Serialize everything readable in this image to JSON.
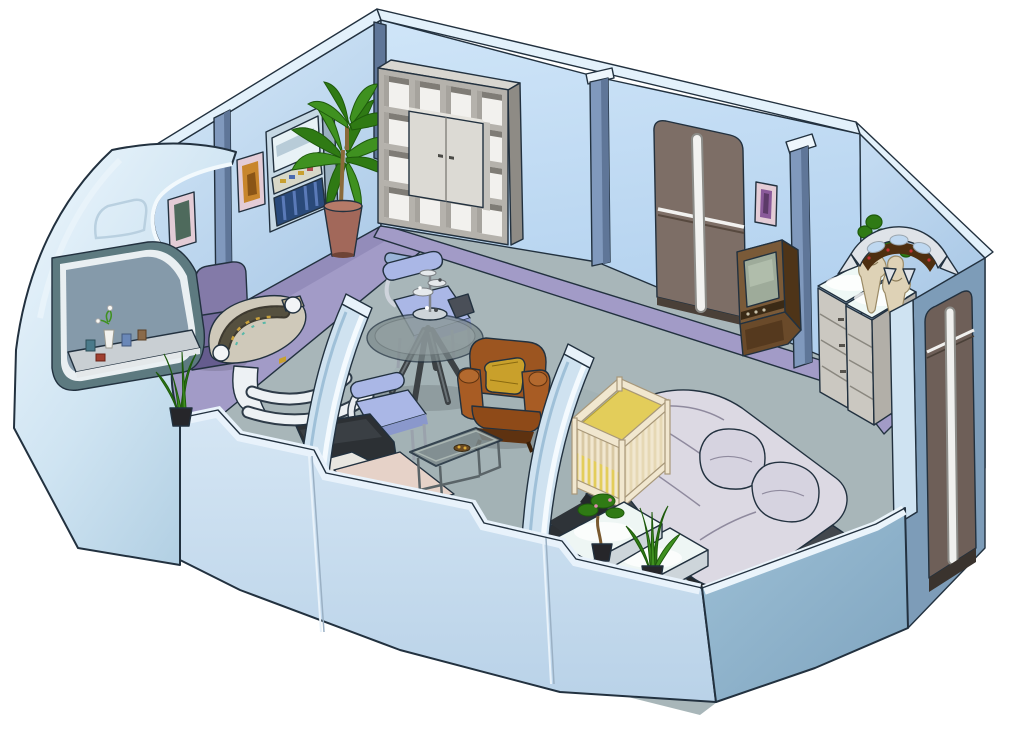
{
  "scene": {
    "type": "isometric-room-cutaway",
    "label": "isometric cutaway illustration of starship living quarters"
  },
  "palette": {
    "bg": "#ffffff",
    "outline": "#22313f",
    "wallCap": "#e3f1fb",
    "pillarLight": "#8099bd",
    "pillarDark": "#5f7698",
    "baseboard": "#a29bc7",
    "baseboardDark": "#877fae",
    "floor": "#a8b6b9",
    "cutFace": "#c9def0",
    "cutTop": "#e8f2fb",
    "cutFaceRight": "#8fb2ca",
    "windowFrame": "#5d7a80",
    "windowBevel": "#e9eff2",
    "windowGlass": "#7c93a4",
    "ledge": "#c9cfd3",
    "archFill": "#cfe2f0",
    "archEdge": "#f4fafe",
    "shelfFront": "#b5b2ac",
    "shelfTop": "#d8d6d0",
    "shelfSide": "#8e8b85",
    "shelfCell": "#f2f1ee",
    "shelfCellShadow": "#7f7c76",
    "cabinet": "#dcdad4",
    "cabinetSide": "#c4c2bc",
    "doorBrown": "#7d6e66",
    "doorDark": "#4a4038",
    "doorStripe": "#f0f0ee",
    "replicatorBody": "#c6d8e4",
    "replicatorSide": "#9ab0c0",
    "replicatorScreen": "#e8f2f6",
    "replicatorPanel": "#2a4a7a",
    "plantGreen": "#3f9120",
    "plantGreenDark": "#2f7a14",
    "plantOutline": "#1e5a0c",
    "potTerracotta": "#a2685a",
    "potRim": "#b57a68",
    "potBlack": "#26262a",
    "tvFront": "#7a5a38",
    "tvSide": "#4e3418",
    "tvTop": "#5e401f",
    "tvScreen": "#9eab9a",
    "tvCabinet": "#6a4a2a",
    "dresserFront": "#cbc8c1",
    "dresserSide": "#b2afa8",
    "glassTop": "#eef8f6",
    "vase": "#ded2b6",
    "batlethSilver": "#dfe3e8",
    "batlethBrown": "#4e2f10",
    "alcoveWall": "#7d9cb8",
    "alcoveCap": "#cfe3f2",
    "bedBase": "#42474d",
    "bedBaseDark": "#2e3338",
    "bedKick": "#cbbfa2",
    "bedding": "#dcd9e3",
    "beddingLine": "#8f8a9e",
    "pillow": "#d6d3e0",
    "cribWood": "#f1e7cf",
    "cribWoodDark": "#a8987a",
    "cribBedding": "#e3cd5a",
    "cribInside": "#d9c9a4",
    "benchFace": "#dfe5e8",
    "benchSide": "#cdd5da",
    "benchGlow": "#eef6f4",
    "armchair": "#9c5520",
    "armchairDark": "#5e3210",
    "armchairMid": "#a85c24",
    "armchairSeat": "#8e4a18",
    "armchairPillow": "#c9a02b",
    "chairBlue": "#aab7e6",
    "chairBlueDark": "#5a68a0",
    "chairBlueFront": "#8a98cc",
    "chairPurple": "#837aa8",
    "chairPurpleMid": "#746b9c",
    "chairPurpleDark": "#655c8e",
    "deskTop": "#cfc9ba",
    "deskConsole": "#3e3a30",
    "deskWhite": "#edf1f4",
    "tableLeg": "#3c4144",
    "couchDark": "#2c3034",
    "couchSeat": "#e6d2c8",
    "couchWhite": "#e8e6e0",
    "framePink": "#e3ccd6",
    "artOrange": "#c8862c",
    "artTeal": "#4e6a5c",
    "artPurple": "#8a5a9a",
    "cylinderBlue": "#9ab4d8"
  },
  "objects": {
    "room": "starship quarters cutaway",
    "floor": "carpeted floor",
    "leftWall": "left wall",
    "rightWall": "right wall with door",
    "batlethWall": "angled wall with bat'leth",
    "pillar1": "wall support pillar",
    "pillar2": "wall support pillar",
    "artSmall": "small framed picture",
    "artOrange": "framed orange artwork",
    "artPurple": "framed purple artwork",
    "replicator": "replicator terminal",
    "plant": "potted dracaena plant",
    "shelving": "cube shelving unit with cabinet",
    "floorCylinder": "rolled mat on floor",
    "mainDoor": "double sliding door",
    "tv": "antique television set",
    "dressers": "drawer dressers with lit glass tops",
    "vases": "decorative vases with plants",
    "batleth": "bat'leth wall weapon",
    "alcove": "entry alcove with door",
    "deskChair": "purple desk chair",
    "desk": "crescent work desk with console",
    "diningTable": "round glass table",
    "chessSet": "tri-dimensional chess set",
    "chairOne": "blue dining chair",
    "chairTwo": "blue dining chair",
    "armchair": "rust armchair with gold pillow",
    "coffeeTable": "glass coffee table",
    "couch": "couch cut by wall",
    "bed": "double bed with bedding and pillows",
    "crib": "wooden baby crib",
    "bench": "foot-of-bed bench with lit top",
    "bonsai": "bonsai plant",
    "aloe": "aloe plant",
    "hull": "curved outer hull",
    "window": "hull viewport window",
    "windowShelf": "window sill shelf with plants",
    "snakePlant": "snake plant in pot",
    "frontWallLeft": "foreground cutaway wall",
    "frontWallRight": "foreground cutaway wall (right)",
    "archOne": "curved partition arch",
    "archTwo": "curved partition arch"
  }
}
